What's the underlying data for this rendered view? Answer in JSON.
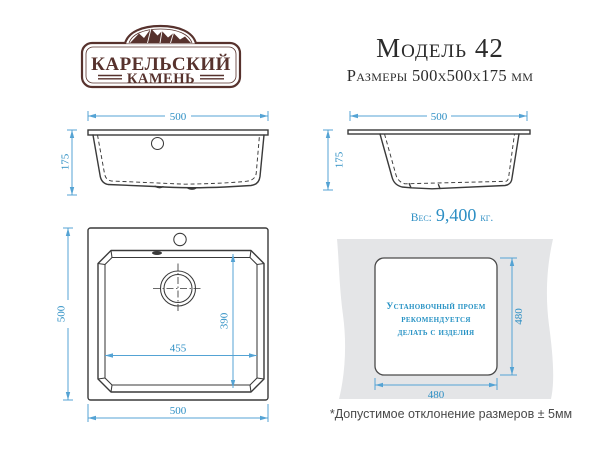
{
  "logo": {
    "line1": "КАРЕЛЬСКИЙ",
    "line2": "КАМЕНЬ"
  },
  "header": {
    "model_title": "Модель 42",
    "dimensions_subtitle": "Размеры 500х500х175 мм"
  },
  "dims": {
    "side_width": "500",
    "side_height": "175",
    "top_outer_w": "500",
    "top_outer_h": "500",
    "bowl_w": "455",
    "bowl_d": "390",
    "cutout_w": "480",
    "cutout_h": "480"
  },
  "weight": {
    "label": "Вес:",
    "value": "9,400",
    "unit": "кг."
  },
  "cutout": {
    "line1": "Установочный проем",
    "line2": "рекомендуется",
    "line3": "делать с изделия"
  },
  "footnote": {
    "text": "*Допустимое отклонение размеров ± 5мм"
  },
  "colors": {
    "ink": "#3a3a3a",
    "dim-blue": "#54a3d4",
    "dim-text": "#2e8fc4",
    "brand-brown": "#57322d",
    "countertop-gray": "#e4e5e7",
    "cutout-blue": "#2692c4",
    "footnote-gray": "#4a4a4a"
  }
}
